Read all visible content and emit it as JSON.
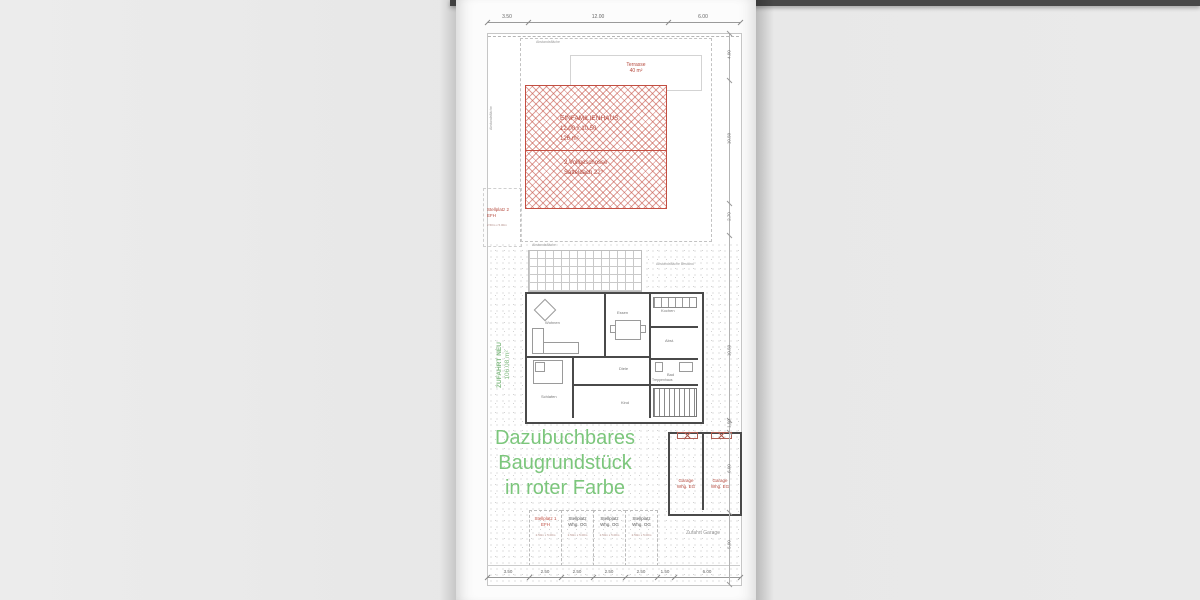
{
  "colors": {
    "accent_red": "#c0473b",
    "accent_green": "#7cc67c",
    "wall_gray": "#4a4a4a"
  },
  "dims": {
    "top": [
      "3.50",
      "12.00",
      "6.00"
    ],
    "bottom": [
      "3.50",
      "2.50",
      "2.50",
      "2.50",
      "2.50",
      "1.50",
      "6.00"
    ],
    "right": [
      "4.00",
      "10.50",
      "2.70",
      "10.50",
      "1.50",
      "6.00",
      "5.00"
    ]
  },
  "house": {
    "name": "EINFAMILIENHAUS",
    "size": "12.00 x 10.50",
    "area": "126 m²",
    "floors": "2 Vollgeschosse",
    "roof": "Satteldach 22°"
  },
  "terrace": {
    "name": "Terrasse",
    "area": "40 m²"
  },
  "stellplatz_efh2": {
    "l1": "Stellplatz 2",
    "l2": "EFH",
    "note": "2.50m x 5.00m"
  },
  "driveway": {
    "name": "ZUFAHRT NEU",
    "area": "106.08 m²"
  },
  "green_note": {
    "l1": "Dazubuchbares",
    "l2": "Baugrundstück",
    "l3": "in roter Farbe"
  },
  "abstand": {
    "top": "Abstandsfläche",
    "left": "Abstandsfläche",
    "mid": "Abstandsfläche",
    "bestand": "Abstandsfläche Bestand"
  },
  "rooms": {
    "wohnen": "Wohnen",
    "essen": "Essen",
    "kochen": "Kochen",
    "abst": "Abst.",
    "diele": "Diele",
    "bad": "Bad",
    "schlafen": "Schlafen",
    "kind": "Kind",
    "treppe": "Treppenhaus"
  },
  "garages": [
    {
      "l1": "Garage",
      "l2": "Whg. EG"
    },
    {
      "l1": "Garage",
      "l2": "Whg. EG"
    }
  ],
  "stalls": [
    {
      "l1": "Stellplatz 1",
      "l2": "EFH",
      "note": "2.50m x 5.00m"
    },
    {
      "l1": "Stellplatz",
      "l2": "Whg. OG",
      "note": "2.50m x 5.00m"
    },
    {
      "l1": "Stellplatz",
      "l2": "Whg. OG",
      "note": "2.50m x 5.00m"
    },
    {
      "l1": "Stellplatz",
      "l2": "Whg. OG",
      "note": "2.50m x 5.00m"
    }
  ],
  "zufahrt_garage": "Zufahrt Garage"
}
